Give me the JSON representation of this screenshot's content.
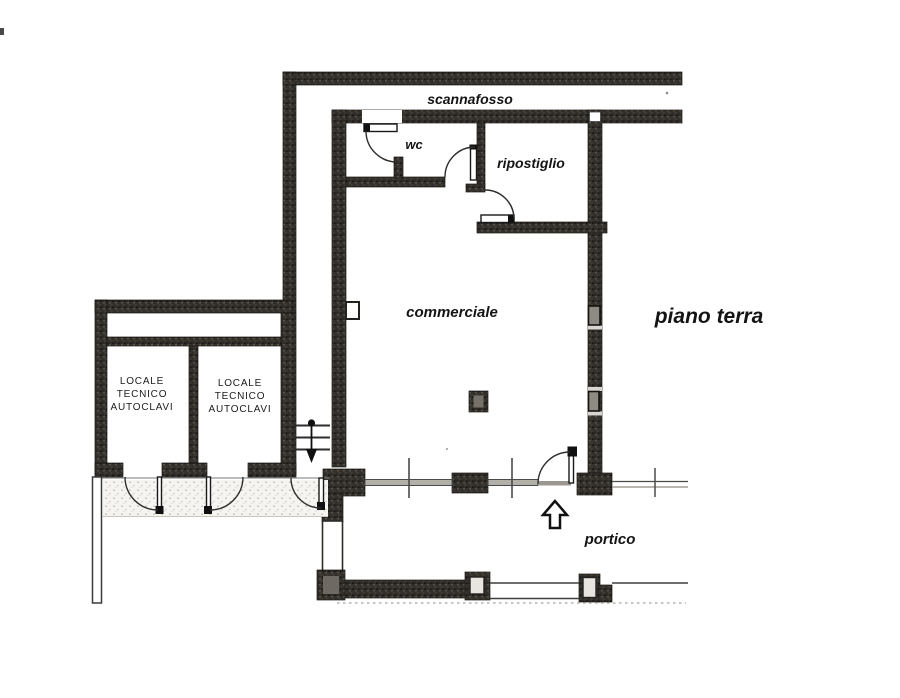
{
  "plan": {
    "title": "piano terra",
    "labels": {
      "scannafosso": "scannafosso",
      "wc": "wc",
      "ripostiglio": "ripostiglio",
      "commerciale": "commerciale",
      "piano_terra": "piano terra",
      "portico": "portico",
      "locale_tecnico": {
        "line1": "LOCALE",
        "line2": "TECNICO",
        "line3": "AUTOCLAVI"
      }
    },
    "colors": {
      "paper": "#ffffff",
      "wall": "#33302b",
      "line": "#333333",
      "glazing": "#b3afa9"
    }
  }
}
